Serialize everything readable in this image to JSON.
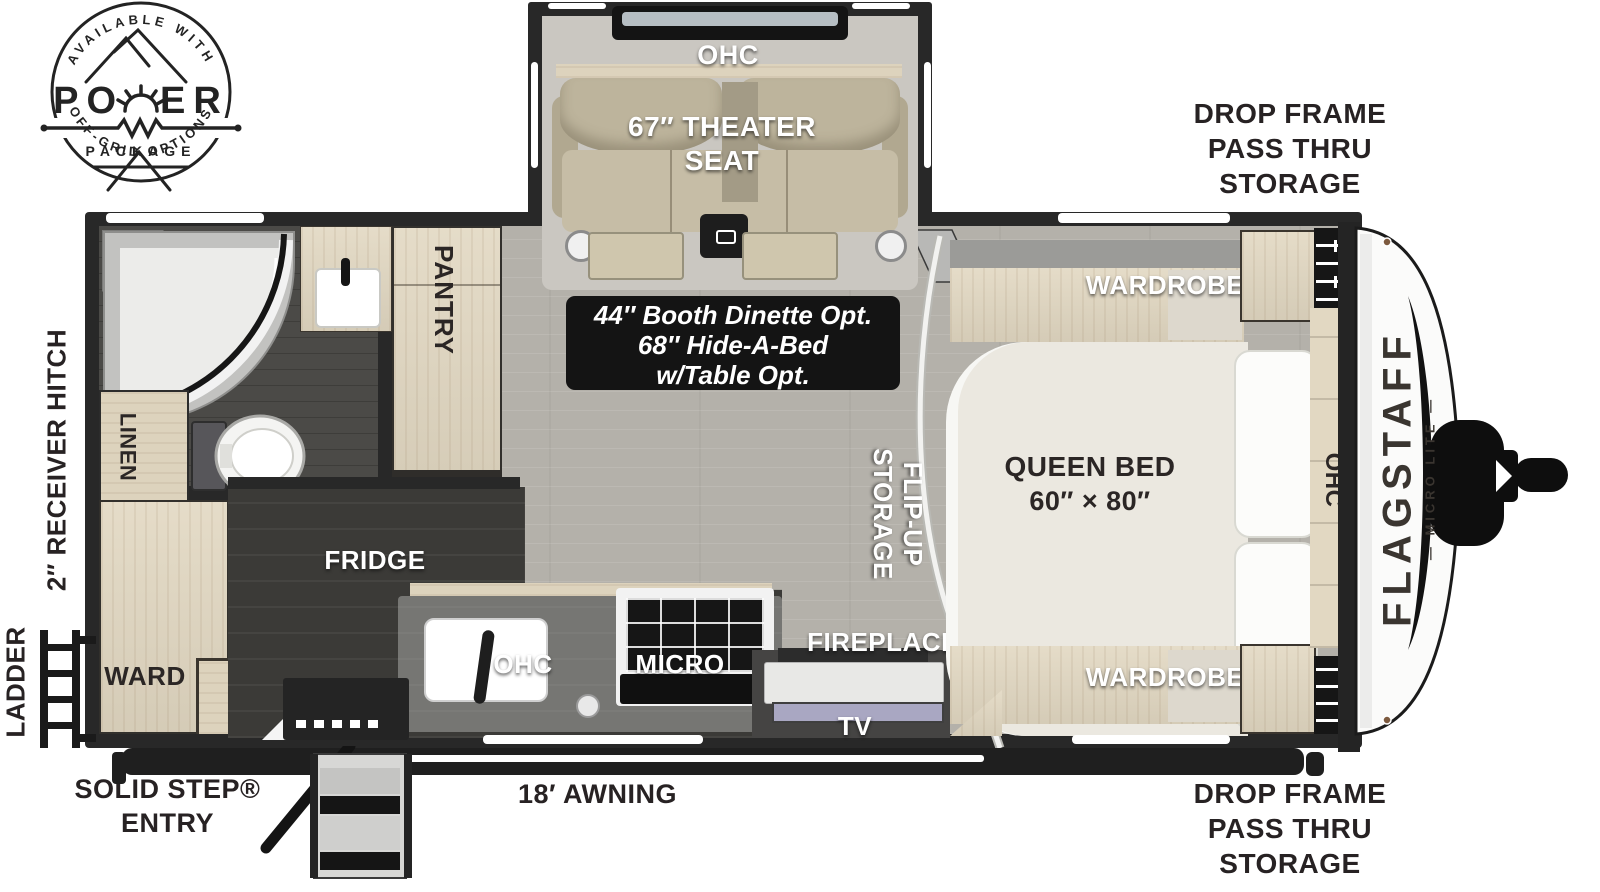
{
  "badge": {
    "arc_top": "AVAILABLE WITH",
    "power_left": "PO",
    "power_right": "ER",
    "package": "PACKAGE",
    "arc_bottom": "OFF-GRID OPTIONS"
  },
  "exterior": {
    "drop_frame_top": [
      "DROP FRAME",
      "PASS THRU",
      "STORAGE"
    ],
    "drop_frame_bottom": [
      "DROP FRAME",
      "PASS THRU",
      "STORAGE"
    ],
    "solid_step": [
      "SOLID STEP®",
      "ENTRY"
    ],
    "awning": "18′ AWNING",
    "receiver_hitch": "2″ RECEIVER HITCH",
    "ladder": "LADDER"
  },
  "slide": {
    "ohc": "OHC",
    "theater_line1": "67″ THEATER",
    "theater_line2": "SEAT"
  },
  "option_box": {
    "line1": "44″ Booth Dinette Opt.",
    "line2": "68″ Hide-A-Bed",
    "line3": "w/Table Opt."
  },
  "interior": {
    "pantry": "PANTRY",
    "linen": "LINEN",
    "ward": "WARD",
    "fridge": "FRIDGE",
    "ohc_kitchen": "OHC",
    "micro": "MICRO",
    "tv": "TV",
    "fireplace": "FIREPLACE",
    "flip_up_line1": "FLIP-UP",
    "flip_up_line2": "STORAGE",
    "wardrobe_top": "WARDROBE",
    "wardrobe_bottom": "WARDROBE",
    "queen_bed_line1": "QUEEN BED",
    "queen_bed_line2": "60″ × 80″",
    "ohc_bedroom": "OHC"
  },
  "brand": {
    "name": "FLAGSTAFF",
    "series": "— MICRO LITE —"
  },
  "colors": {
    "wall": "#282828",
    "floor": "#b4b1aa",
    "wood": "#e2d8c2",
    "label_dark": "#2b2625",
    "exterior_text": "#272223"
  }
}
